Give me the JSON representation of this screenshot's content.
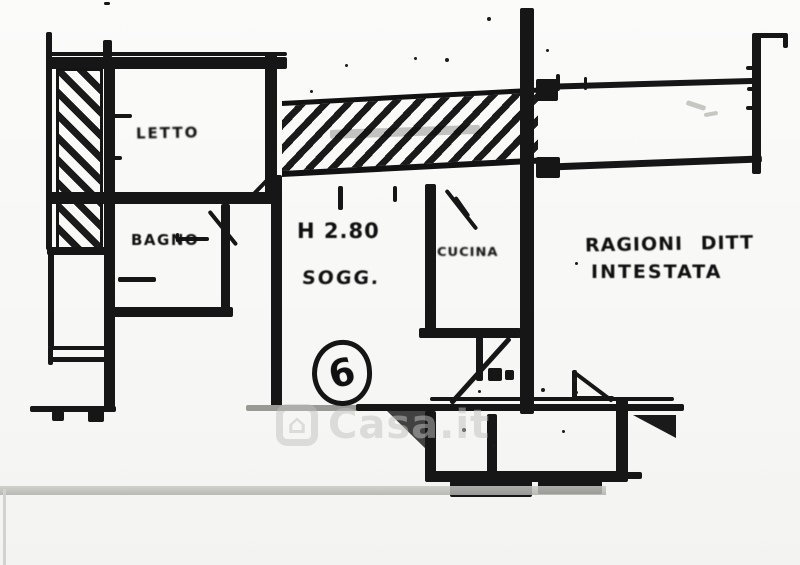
{
  "plan": {
    "title": "Scanned floor plan",
    "rooms": [
      {
        "name": "letto",
        "label": "LETTO"
      },
      {
        "name": "bagno",
        "label": "BAGNO"
      },
      {
        "name": "soggiorno",
        "label": "SOGG."
      },
      {
        "name": "cucina",
        "label": "CUCINA"
      }
    ],
    "annotations": {
      "ceiling_height": "H 2.80",
      "unit_number": "6",
      "note_line1": "RAGIONI DITT",
      "note_line2": "INTESTATA"
    },
    "watermark": {
      "text": "Casa.it",
      "icon": "house-icon"
    },
    "colors": {
      "ink": "#161616",
      "paper": "#f7f7f5",
      "watermark": "#c2c2c2",
      "scan_band": "#bdbdbd"
    }
  }
}
